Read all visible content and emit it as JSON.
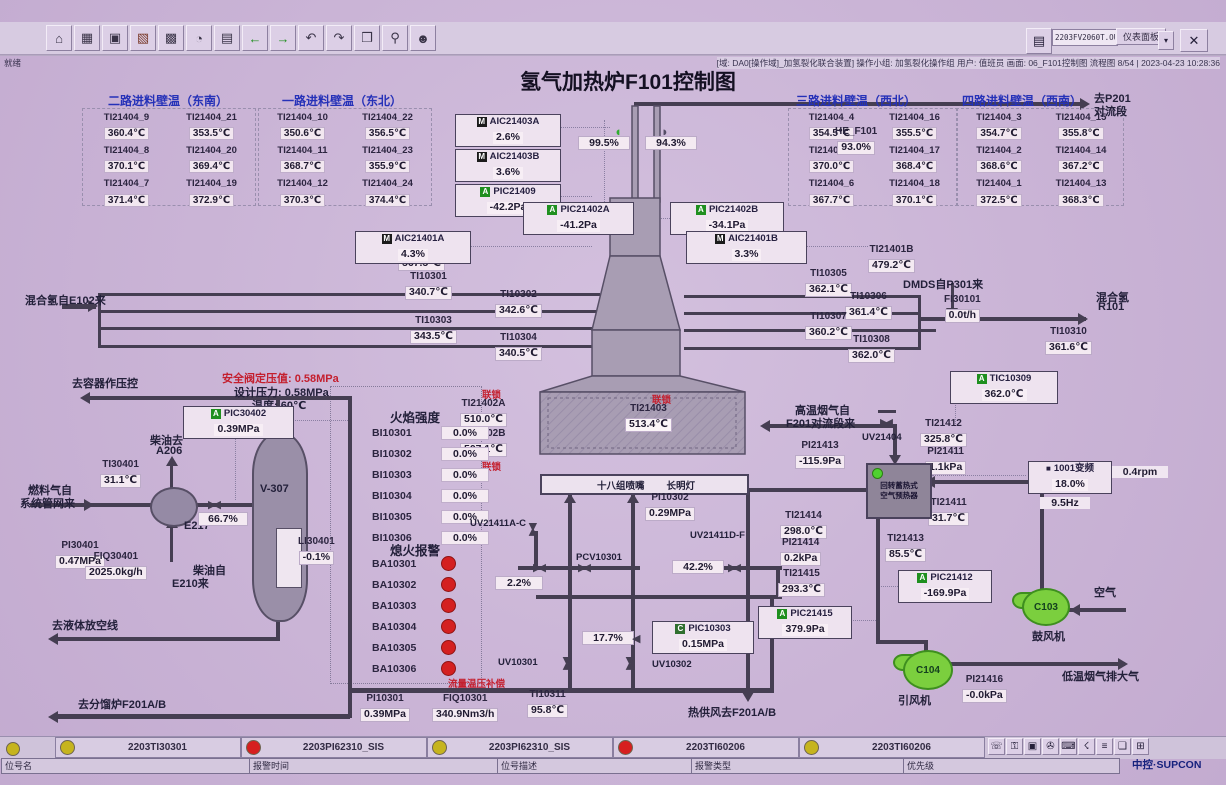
{
  "title": "氢气加热炉F101控制图",
  "window": {
    "address": "2203FV2060T.OUT",
    "panel_button": "仪表面板",
    "close_button": "✕",
    "status_left": "就绪",
    "status_right": "[域: DA0[操作域]_加氢裂化联合装置] 操作小组: 加氢裂化操作组 用户: 值班员 画面: 06_F101控制图 流程图 8/54 | 2023-04-23 10:28:36",
    "toolbar_icons": [
      {
        "name": "home-icon",
        "glyph": "⌂",
        "color": "#3a3448"
      },
      {
        "name": "table-icon",
        "glyph": "▦",
        "color": "#3a3448"
      },
      {
        "name": "window-icon",
        "glyph": "▣",
        "color": "#3a3448"
      },
      {
        "name": "trend-icon",
        "glyph": "▧",
        "color": "#7a3a2a"
      },
      {
        "name": "grid-icon",
        "glyph": "▩",
        "color": "#3a3448"
      },
      {
        "name": "clock-icon",
        "glyph": "◔",
        "color": "#3a3448"
      },
      {
        "name": "report-icon",
        "glyph": "▤",
        "color": "#3a3448"
      },
      {
        "name": "back-icon",
        "glyph": "←",
        "color": "#1f8f1f"
      },
      {
        "name": "forward-icon",
        "glyph": "→",
        "color": "#1f8f1f"
      },
      {
        "name": "page-prev-icon",
        "glyph": "↶",
        "color": "#3a3448"
      },
      {
        "name": "page-next-icon",
        "glyph": "↷",
        "color": "#3a3448"
      },
      {
        "name": "book-icon",
        "glyph": "❒",
        "color": "#3a3448"
      },
      {
        "name": "search-icon",
        "glyph": "⚲",
        "color": "#3a3448"
      },
      {
        "name": "user-icon",
        "glyph": "☻",
        "color": "#3a3448"
      }
    ]
  },
  "wall_temp_groups": [
    {
      "title": "二路进料壁温（东南）",
      "items": [
        {
          "tag": "TI21404_9",
          "value": "360.4℃"
        },
        {
          "tag": "TI21404_21",
          "value": "353.5℃"
        },
        {
          "tag": "TI21404_8",
          "value": "370.1℃"
        },
        {
          "tag": "TI21404_20",
          "value": "369.4℃"
        },
        {
          "tag": "TI21404_7",
          "value": "371.4℃"
        },
        {
          "tag": "TI21404_19",
          "value": "372.9℃"
        }
      ]
    },
    {
      "title": "一路进料壁温（东北）",
      "items": [
        {
          "tag": "TI21404_10",
          "value": "350.6℃"
        },
        {
          "tag": "TI21404_22",
          "value": "356.5℃"
        },
        {
          "tag": "TI21404_11",
          "value": "368.7℃"
        },
        {
          "tag": "TI21404_23",
          "value": "355.9℃"
        },
        {
          "tag": "TI21404_12",
          "value": "370.3℃"
        },
        {
          "tag": "TI21404_24",
          "value": "374.4℃"
        }
      ]
    },
    {
      "title": "三路进料壁温（西北）",
      "items": [
        {
          "tag": "TI21404_4",
          "value": "354.5℃"
        },
        {
          "tag": "TI21404_16",
          "value": "355.5℃"
        },
        {
          "tag": "TI21404_5",
          "value": "370.0℃"
        },
        {
          "tag": "TI21404_17",
          "value": "368.4℃"
        },
        {
          "tag": "TI21404_6",
          "value": "367.7℃"
        },
        {
          "tag": "TI21404_18",
          "value": "370.1℃"
        }
      ]
    },
    {
      "title": "四路进料壁温（西南）",
      "items": [
        {
          "tag": "TI21404_3",
          "value": "354.7℃"
        },
        {
          "tag": "TI21404_15",
          "value": "355.8℃"
        },
        {
          "tag": "TI21404_2",
          "value": "368.6℃"
        },
        {
          "tag": "TI21404_14",
          "value": "367.2℃"
        },
        {
          "tag": "TI21404_1",
          "value": "372.5℃"
        },
        {
          "tag": "TI21404_13",
          "value": "368.3℃"
        }
      ]
    }
  ],
  "instruments": {
    "ti21401a": {
      "tag": "TI21401A",
      "value": "567.5℃"
    },
    "ti10301": {
      "tag": "TI10301",
      "value": "340.7℃"
    },
    "ti10302": {
      "tag": "TI10302",
      "value": "342.6℃"
    },
    "ti10303": {
      "tag": "TI10303",
      "value": "343.5℃"
    },
    "ti10304": {
      "tag": "TI10304",
      "value": "340.5℃"
    },
    "ti21401b": {
      "tag": "TI21401B",
      "value": "479.2℃"
    },
    "ti10305": {
      "tag": "TI10305",
      "value": "362.1℃"
    },
    "ti10306": {
      "tag": "TI10306",
      "value": "361.4℃"
    },
    "ti10307": {
      "tag": "TI10307",
      "value": "360.2℃"
    },
    "ti10308": {
      "tag": "TI10308",
      "value": "362.0℃"
    },
    "fi30101": {
      "tag": "FI30101",
      "value": "0.0t/h"
    },
    "ti10310": {
      "tag": "TI10310",
      "value": "361.6℃"
    },
    "he_f101": {
      "tag": "HE_F101",
      "value": "93.0%"
    },
    "ti21402a": {
      "tag": "TI21402A",
      "value": "510.0℃"
    },
    "ti21402b": {
      "tag": "TI21402B",
      "value": "507.1℃"
    },
    "ti21403": {
      "tag": "TI21403",
      "value": "513.4℃"
    },
    "pi10302": {
      "tag": "PI10302",
      "value": "0.29MPa"
    },
    "ti30401": {
      "tag": "TI30401",
      "value": "31.1℃"
    },
    "pi30401": {
      "tag": "PI30401",
      "value": "0.47MPa"
    },
    "fiq30401": {
      "tag": "FIQ30401",
      "value": "2025.0kg/h"
    },
    "li30401": {
      "tag": "LI30401",
      "value": "-0.1%"
    },
    "pi10301": {
      "tag": "PI10301",
      "value": "0.39MPa"
    },
    "fiq10301": {
      "tag": "FIQ10301",
      "value": "340.9Nm3/h"
    },
    "ti10311": {
      "tag": "TI10311",
      "value": "95.8℃"
    },
    "ti21412": {
      "tag": "TI21412",
      "value": "325.8℃"
    },
    "pi21413": {
      "tag": "PI21413",
      "value": "-115.9Pa"
    },
    "pi21411": {
      "tag": "PI21411",
      "value": "1.1kPa"
    },
    "ti21411": {
      "tag": "TI21411",
      "value": "31.7℃"
    },
    "ti21414": {
      "tag": "TI21414",
      "value": "298.0℃"
    },
    "pi21414": {
      "tag": "PI21414",
      "value": "0.2kPa"
    },
    "ti21413": {
      "tag": "TI21413",
      "value": "85.5℃"
    },
    "ti21415": {
      "tag": "TI21415",
      "value": "293.3℃"
    },
    "pi21416": {
      "tag": "PI21416",
      "value": "-0.0kPa"
    }
  },
  "iboxes": {
    "aic21403a": {
      "icon": "M",
      "bg": "#1b1b1b",
      "tag": "AIC21403A",
      "value": "2.6%"
    },
    "aic21403b": {
      "icon": "M",
      "bg": "#1b1b1b",
      "tag": "AIC21403B",
      "value": "3.6%"
    },
    "pic21409": {
      "icon": "A",
      "bg": "#1f8f1f",
      "tag": "PIC21409",
      "value": "-42.2Pa"
    },
    "pic21402a": {
      "icon": "A",
      "bg": "#1f8f1f",
      "tag": "PIC21402A",
      "value": "-41.2Pa"
    },
    "pic21402b": {
      "icon": "A",
      "bg": "#1f8f1f",
      "tag": "PIC21402B",
      "value": "-34.1Pa"
    },
    "aic21401a": {
      "icon": "M",
      "bg": "#1b1b1b",
      "tag": "AIC21401A",
      "value": "4.3%"
    },
    "aic21401b": {
      "icon": "M",
      "bg": "#1b1b1b",
      "tag": "AIC21401B",
      "value": "3.3%"
    },
    "pic30402": {
      "icon": "A",
      "bg": "#1f8f1f",
      "tag": "PIC30402",
      "value": "0.39MPa"
    },
    "tic10309": {
      "icon": "A",
      "bg": "#1f8f1f",
      "tag": "TIC10309",
      "value": "362.0℃"
    },
    "pic10303": {
      "icon": "C",
      "bg": "#2f6f2f",
      "tag": "PIC10303",
      "value": "0.15MPa"
    },
    "pic21412": {
      "icon": "A",
      "bg": "#1f8f1f",
      "tag": "PIC21412",
      "value": "-169.9Pa"
    },
    "pic21415": {
      "icon": "A",
      "bg": "#1f8f1f",
      "tag": "PIC21415",
      "value": "379.9Pa"
    }
  },
  "valueboxes": {
    "damper_a": "99.5%",
    "damper_b": "94.3%",
    "fuel_valve": "66.7%",
    "v2_2": "2.2%",
    "v42_2": "42.2%",
    "v17_7": "17.7%"
  },
  "vfd": {
    "icon": "■",
    "name": "1001变频",
    "percent": "18.0%",
    "hz": "9.5Hz",
    "rpm": "0.4rpm"
  },
  "flame_rows": [
    {
      "tag": "BI10301",
      "value": "0.0%"
    },
    {
      "tag": "BI10302",
      "value": "0.0%"
    },
    {
      "tag": "BI10303",
      "value": "0.0%"
    },
    {
      "tag": "BI10304",
      "value": "0.0%"
    },
    {
      "tag": "BI10305",
      "value": "0.0%"
    },
    {
      "tag": "BI10306",
      "value": "0.0%"
    }
  ],
  "flameout_rows": [
    {
      "tag": "BA10301"
    },
    {
      "tag": "BA10302"
    },
    {
      "tag": "BA10303"
    },
    {
      "tag": "BA10304"
    },
    {
      "tag": "BA10305"
    },
    {
      "tag": "BA10306"
    }
  ],
  "labels": {
    "to_p201_l1": "去P201",
    "to_p201_l2": "对流段",
    "mix_h2_in": "混合氢自E102来",
    "dmds": "DMDS自P301来",
    "mix_h2_out_l1": "混合氢",
    "mix_h2_out_l2": "R101",
    "to_vessel": "去容器作压控",
    "safety": "安全阀定压值: 0.58MPa",
    "design": "设计压力: 0.58MPa",
    "temp60": "温度: 60℃",
    "diesel_to_l1": "柴油去",
    "diesel_to_l2": "A206",
    "fuel_l1": "燃料气自",
    "fuel_l2": "系统管网来",
    "e217": "E217",
    "v307": "V-307",
    "diesel_from_l1": "柴油自",
    "diesel_from_l2": "E210来",
    "to_liquid": "去液体放空线",
    "to_f201ab": "去分馏炉F201A/B",
    "flame_title": "火焰强度",
    "flameout_title": "熄火报警",
    "interlock": "联锁",
    "burners": "十八组喷嘴",
    "pilot": "长明灯",
    "uv21411ac": "UV21411A-C",
    "pcv10301": "PCV10301",
    "uv21411df": "UV21411D-F",
    "uv10301": "UV10301",
    "uv10302": "UV10302",
    "uv21404": "UV21404",
    "flow_comp": "流量温压补偿",
    "hot_air": "热供风去F201A/B",
    "flue_l1": "高温烟气自",
    "flue_l2": "F201对流段来",
    "preheater_l1": "回转蓄热式",
    "preheater_l2": "空气预热器",
    "air": "空气",
    "blower": "鼓风机",
    "inducer": "引风机",
    "c103": "C103",
    "c104": "C104",
    "low_flue": "低温烟气排大气"
  },
  "alarm_bar": {
    "cells": [
      {
        "color": "#c6b41e",
        "label": "2203TI30301"
      },
      {
        "color": "#d61f1f",
        "label": "2203PI62310_SIS"
      },
      {
        "color": "#c6b41e",
        "label": "2203PI62310_SIS"
      },
      {
        "color": "#d61f1f",
        "label": "2203TI60206"
      },
      {
        "color": "#c6b41e",
        "label": "2203TI60206"
      }
    ],
    "fields": [
      {
        "label": "位号名"
      },
      {
        "label": "报警时间"
      },
      {
        "label": "位号描述"
      },
      {
        "label": "报警类型"
      },
      {
        "label": "优先级"
      }
    ],
    "icons": [
      {
        "glyph": "☏"
      },
      {
        "glyph": "⚿"
      },
      {
        "glyph": "▣"
      },
      {
        "glyph": "✇"
      },
      {
        "glyph": "⌨"
      },
      {
        "glyph": "☇"
      },
      {
        "glyph": "≡"
      },
      {
        "glyph": "❏"
      },
      {
        "glyph": "⊞"
      }
    ],
    "logo": "中控·SUPCON"
  }
}
